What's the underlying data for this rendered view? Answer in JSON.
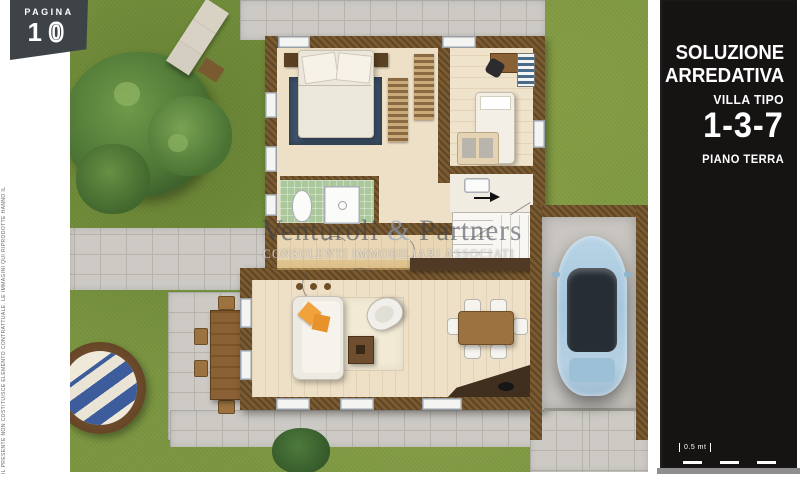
{
  "page_badge": {
    "label": "PAGINA",
    "digits": [
      "1",
      "0"
    ]
  },
  "sidebar": {
    "title_line1": "SOLUZIONE",
    "title_line2": "ARREDATIVA",
    "subtitle": "VILLA TIPO",
    "type_number": "1-3-7",
    "floor_label": "PIANO TERRA",
    "scale_label": "0.5 mt"
  },
  "watermark": {
    "brand_word1": "Venturoli",
    "ampersand": "&",
    "brand_word2": "Partners",
    "tagline": "CONSULENTI IMMOBILIARI ASSOCIATI"
  },
  "disclaimer": "IL PRESENTE NON COSTITUISCE ELEMENTO CONTRATTUALE. LE IMMAGINI QUI RIPRODOTTE HANNO IL SOLO SCOPO INDICATIVO",
  "colors": {
    "sidebar_bg": "#161313",
    "badge_bg": "#3d4347",
    "grass": "#7d9843",
    "pavement": "#cdcac5",
    "wall_brown": "#7a5a30",
    "interior_floor": "#eee0c6",
    "bathroom_floor": "#abc89c",
    "rug_blue": "#3f536c",
    "pillow_orange": "#f0a23c",
    "car_blue": "#a6c6dc",
    "table_wood": "#9c7340",
    "kitchen_counter": "#402e1f",
    "gray_strip": "#8f8f8f"
  },
  "plan_elements": [
    "garden-tree",
    "sun-lounger",
    "round-daybed",
    "outdoor-dining-table",
    "garden-bush",
    "walkway",
    "patio",
    "double-bed",
    "blue-rug",
    "wardrobe",
    "single-bed",
    "sofa-bed",
    "desk",
    "desk-chair",
    "bookshelf",
    "toilet",
    "shower",
    "stairs",
    "sofa",
    "orange-pillows",
    "armchair",
    "coffee-table",
    "living-rug",
    "dining-table",
    "dining-chairs",
    "kitchen-counter",
    "kitchen-cabinets",
    "garage",
    "car",
    "driveway"
  ]
}
